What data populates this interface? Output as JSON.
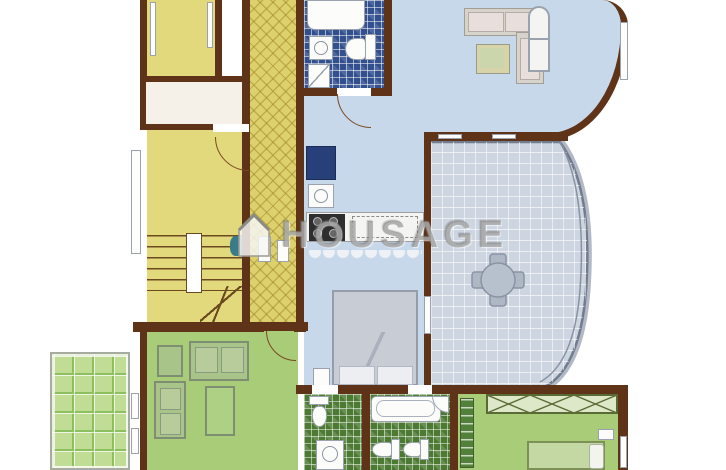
{
  "watermark": {
    "text": "HOUSAGE",
    "logo": "house-logo-icon"
  },
  "palette": {
    "wall": "#5e3317",
    "wall-light": "#7a4a22",
    "room-yellow": "#e2d87c",
    "corridor-yellow": "#ddd16e",
    "room-blue": "#c6d8ea",
    "tile-blue": "#32508e",
    "glass-blue": "#cdd5e1",
    "room-green": "#a8cc77",
    "balcony-green": "#c1dd95",
    "tile-green": "#4c7a33",
    "closet-white": "#f6f1e8",
    "furniture-gray": "#d6d2cc",
    "watermark-gray": "#7a7a7a"
  },
  "rooms": [
    {
      "id": "bedroom-top-left",
      "color": "#e2d87c"
    },
    {
      "id": "closet",
      "color": "#f6f1e8"
    },
    {
      "id": "room-middle-left",
      "color": "#e2d87c"
    },
    {
      "id": "staircase",
      "color": "#e2d87c"
    },
    {
      "id": "corridor",
      "color": "#ddd16e"
    },
    {
      "id": "bathroom-top",
      "color": "#32508e"
    },
    {
      "id": "living-dining-top",
      "color": "#c6d8ea"
    },
    {
      "id": "kitchen",
      "color": "#c6d8ea"
    },
    {
      "id": "bedroom-middle",
      "color": "#c6d8ea"
    },
    {
      "id": "winter-garden",
      "color": "#cdd5e1"
    },
    {
      "id": "living-room-lower",
      "color": "#a8cc77"
    },
    {
      "id": "balcony",
      "color": "#c1dd95"
    },
    {
      "id": "bathroom-lower-left",
      "color": "#4c7a33"
    },
    {
      "id": "bathroom-lower-right",
      "color": "#4c7a33"
    },
    {
      "id": "bedroom-bottom-right",
      "color": "#a9cc79"
    }
  ]
}
